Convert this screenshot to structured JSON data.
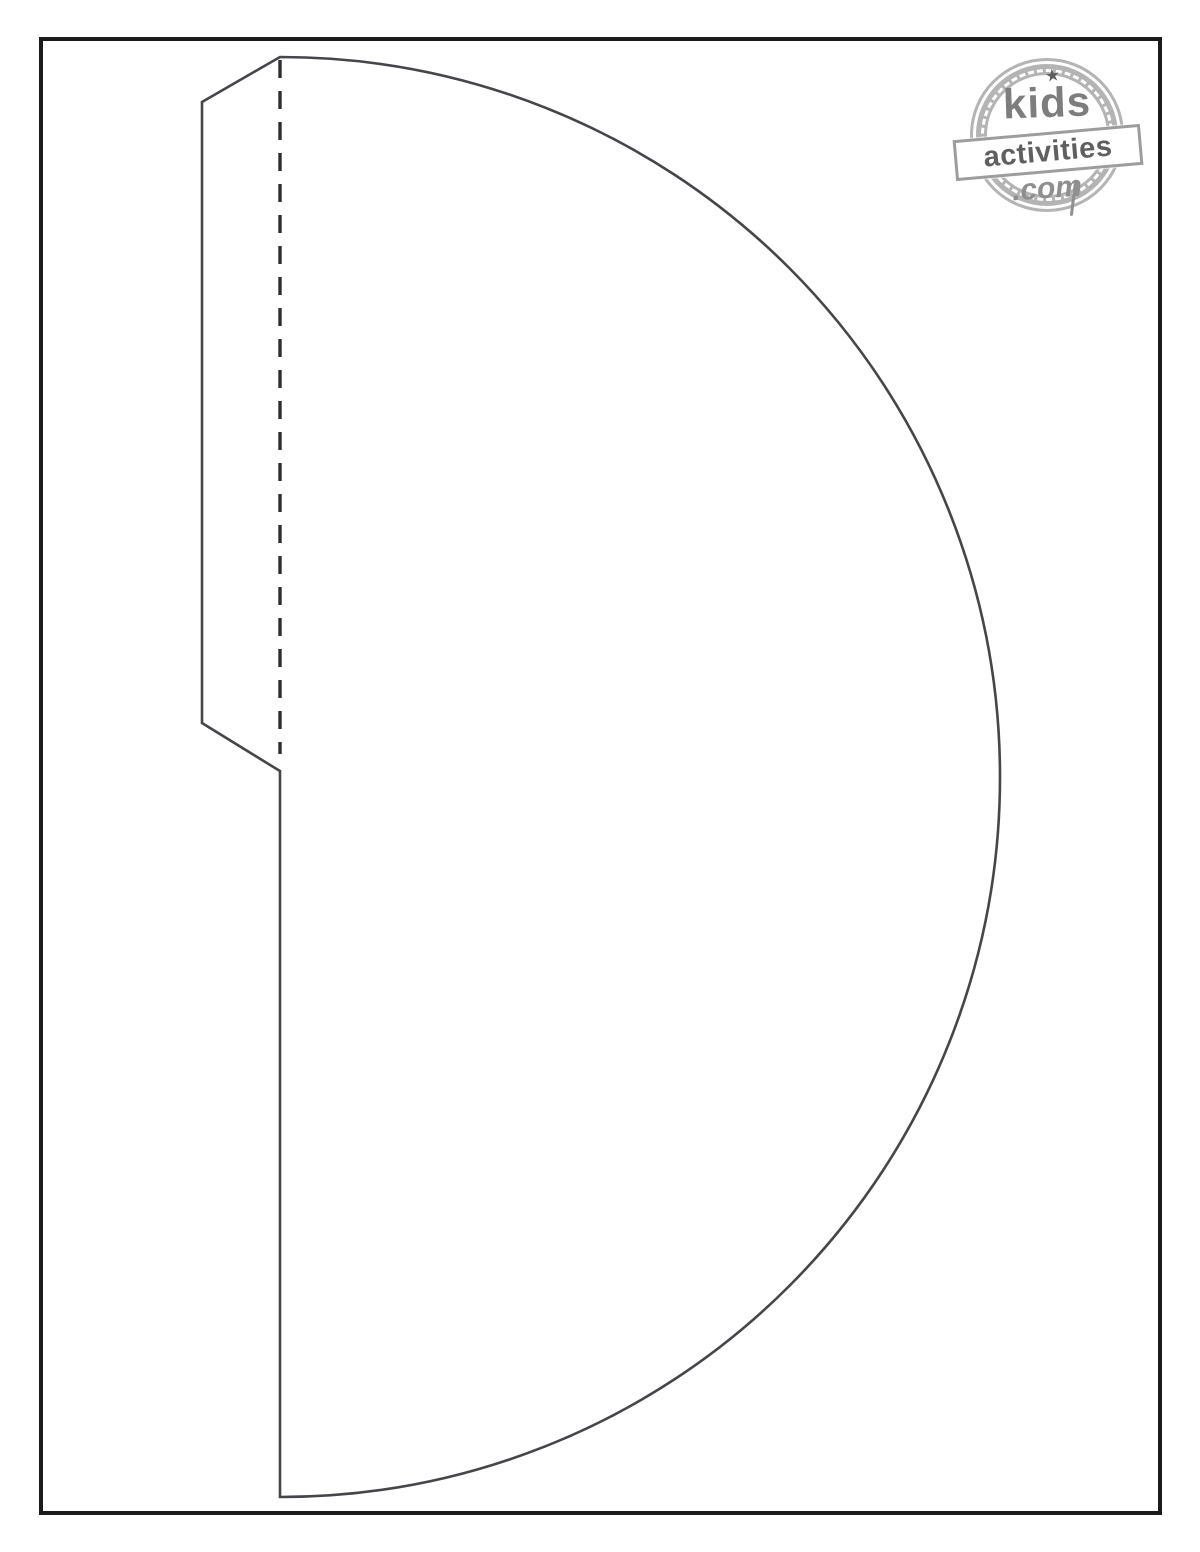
{
  "page": {
    "description": "Blank printable craft template page with cut outline, fold line and glue tab",
    "background_color": "#ffffff",
    "frame_border_color": "#1b1b1e"
  },
  "template": {
    "shape": "semicircle with vertical chord, upper-left glue tab",
    "line_color": "#46464a",
    "fold_line_color": "#2e2e31",
    "fold_dash_pattern": "18 13",
    "cut_path_d": "M 280 57 A 720 720 0 0 1 280 1497 L 280 771 L 275 768 L 202 723 L 202 102 Z",
    "fold_line_d": "M 280 60 L 280 754"
  },
  "logo": {
    "kids": "kids",
    "activities": "activities",
    "com": ".com",
    "star_icon": "★",
    "ring_color": "#b4b4b4",
    "kids_color": "#7d7d7d",
    "activities_color": "#5f5f5f",
    "com_color": "#8f8f8f"
  }
}
